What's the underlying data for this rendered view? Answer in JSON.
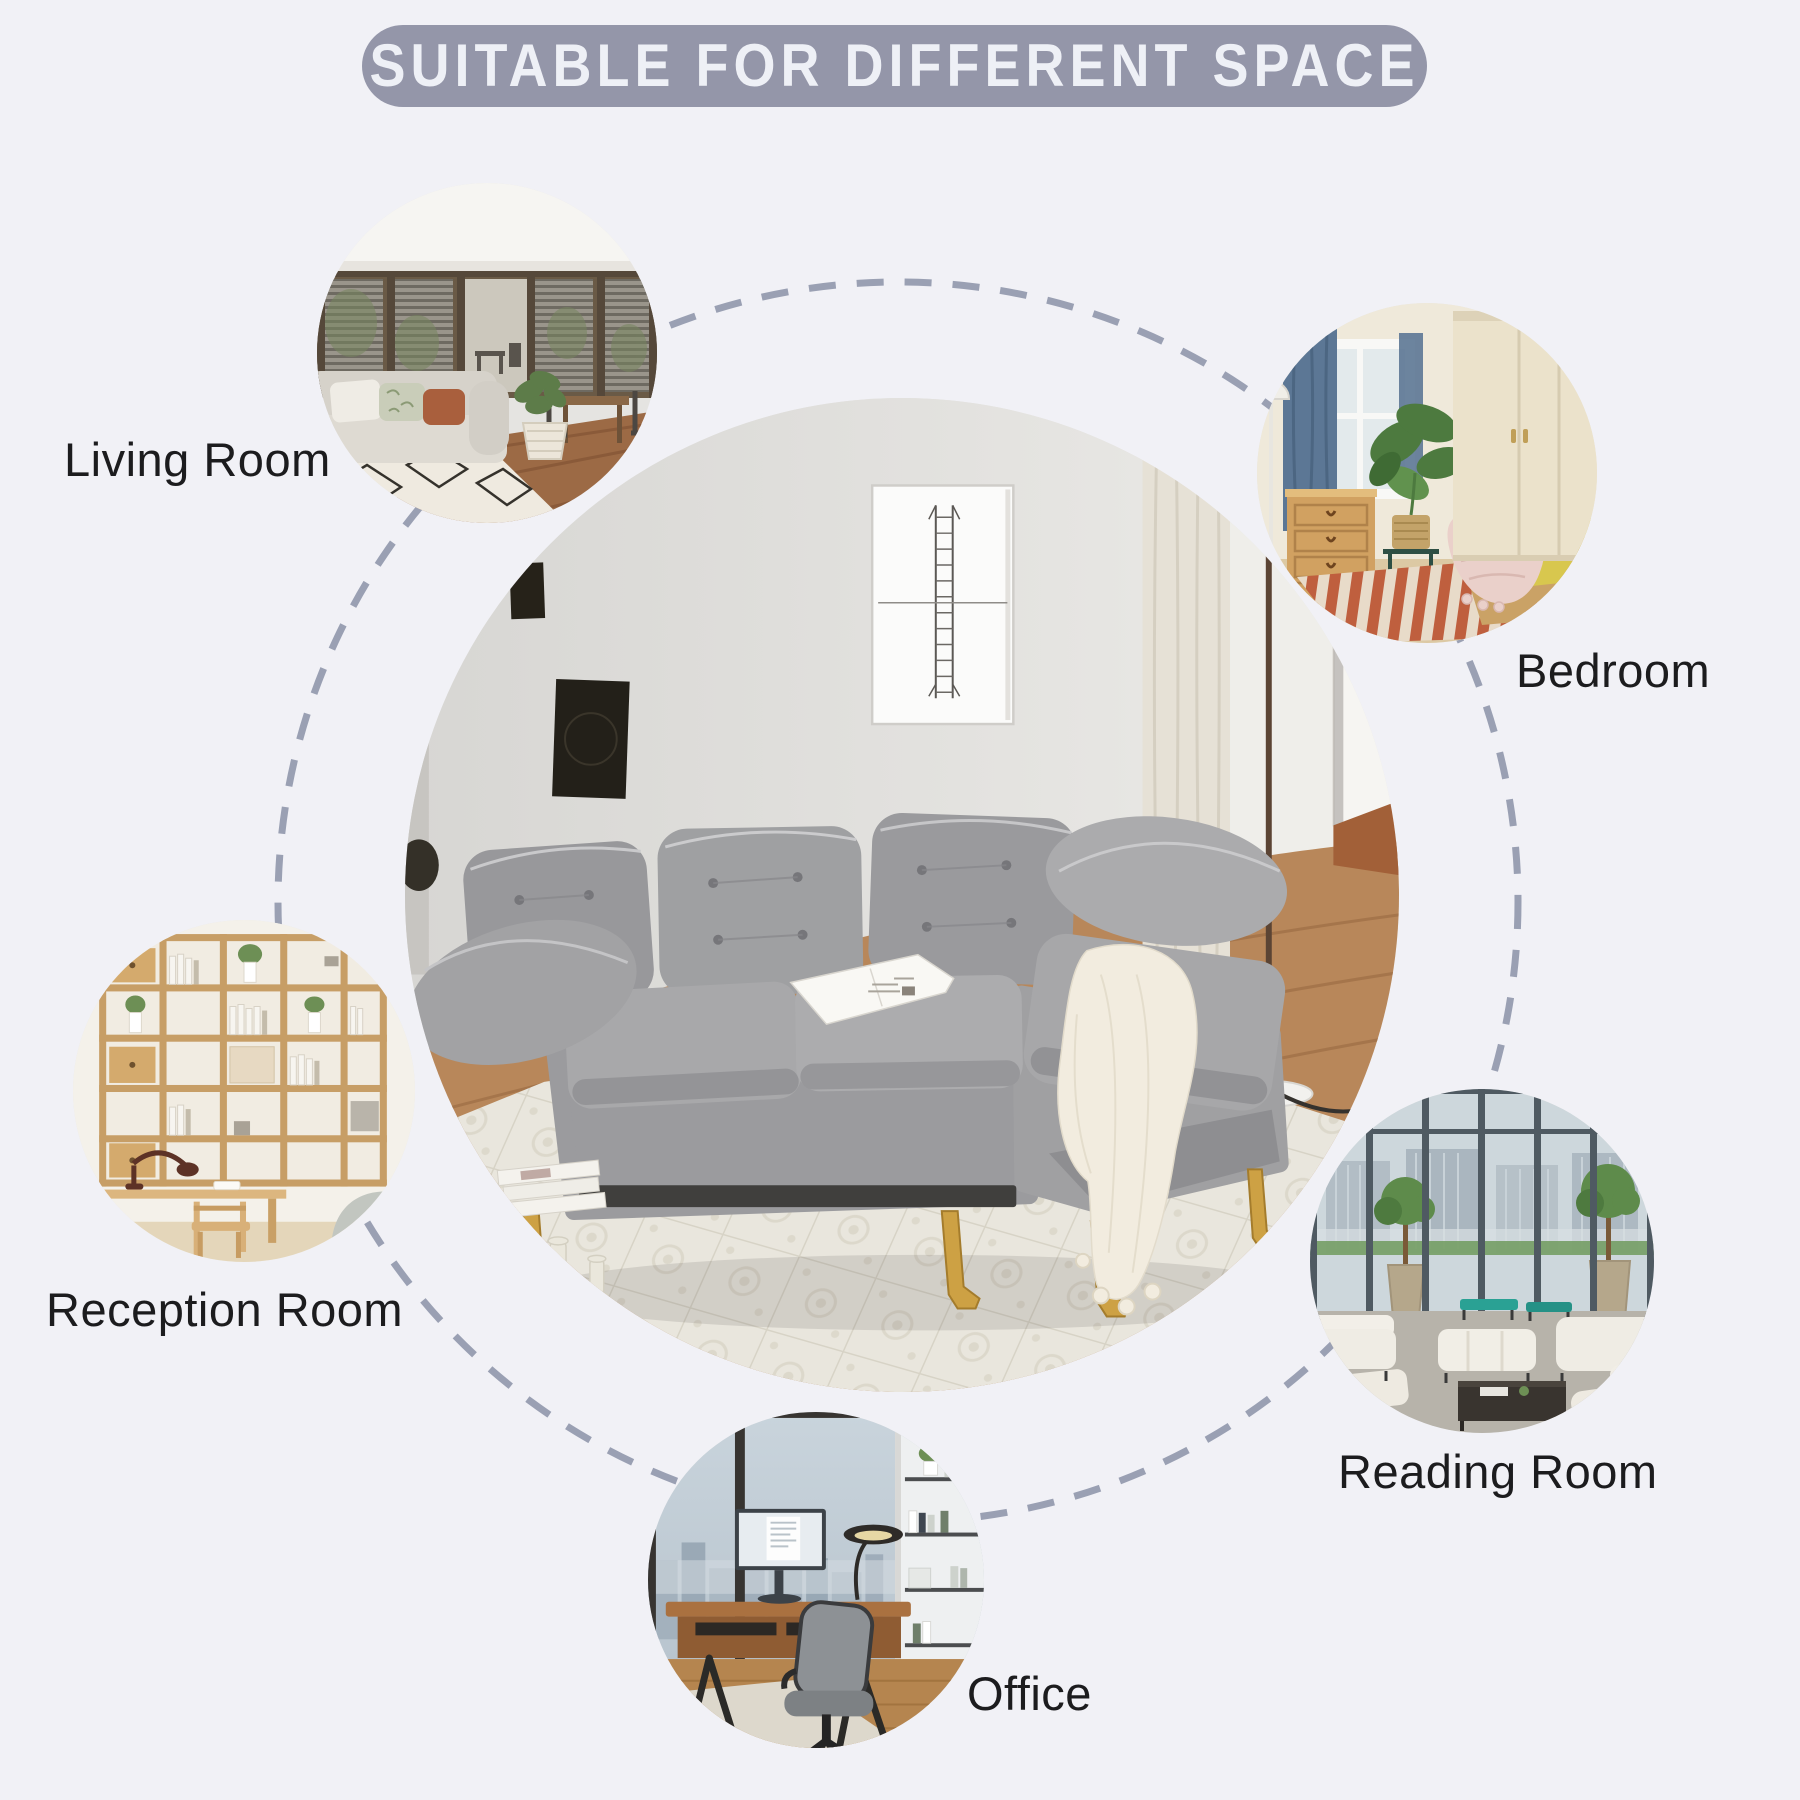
{
  "title": "SUITABLE FOR DIFFERENT SPACE",
  "spaces": [
    {
      "id": "living-room",
      "label": "Living Room"
    },
    {
      "id": "bedroom",
      "label": "Bedroom"
    },
    {
      "id": "reception-room",
      "label": "Reception Room"
    },
    {
      "id": "reading-room",
      "label": "Reading Room"
    },
    {
      "id": "office",
      "label": "Office"
    }
  ],
  "colors": {
    "background": "#f1f1f6",
    "banner_fill": "#9496a9",
    "banner_text": "#eef0f6",
    "dashed_ring": "#9aa0b3",
    "label_text": "#1c1c1e",
    "sofa_fabric": "#a0a0a2",
    "sofa_leg_gold": "#cda144"
  }
}
